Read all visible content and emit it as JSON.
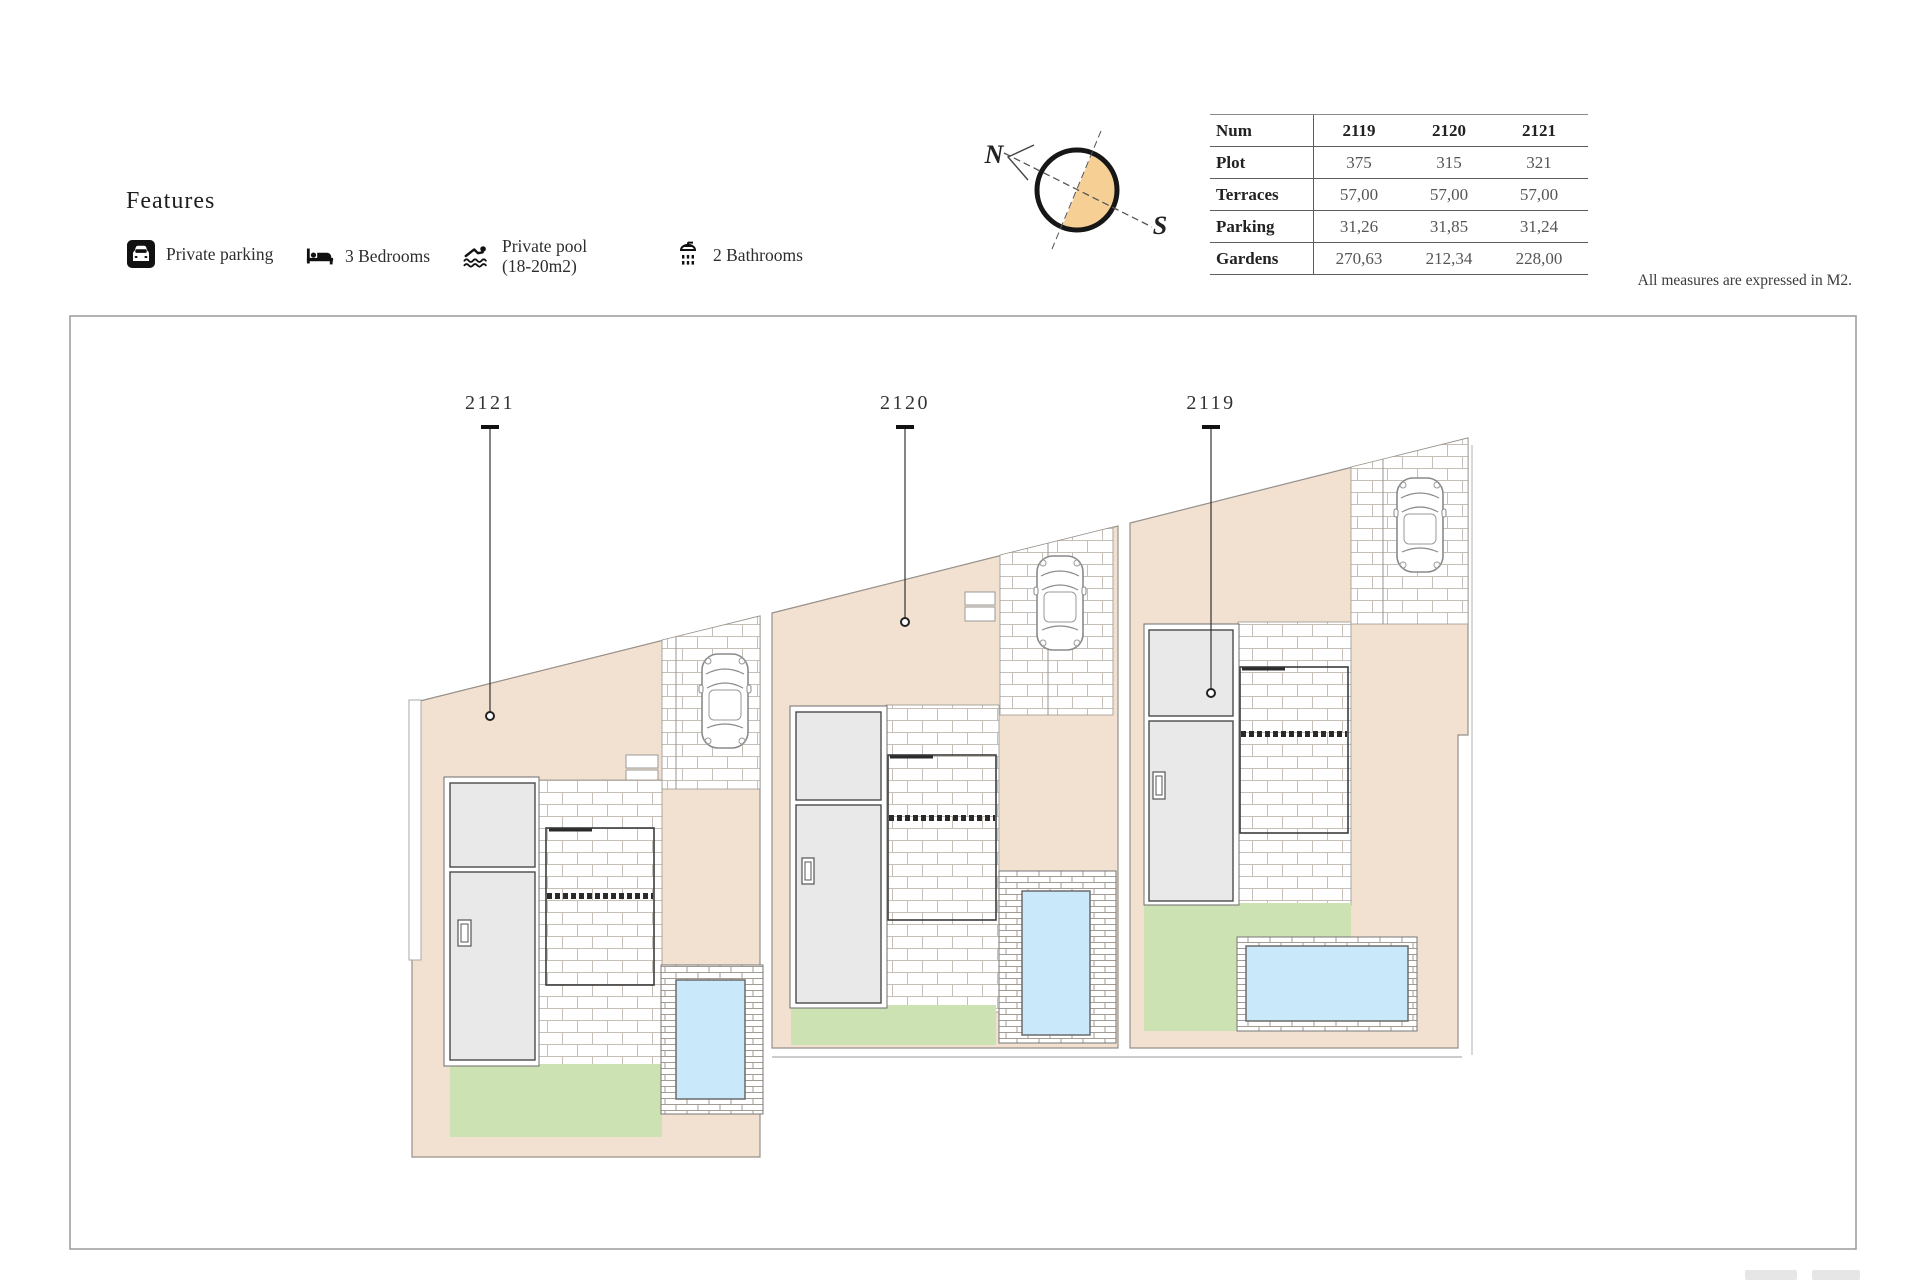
{
  "features": {
    "title": "Features",
    "items": [
      {
        "icon": "parking-icon",
        "label": "Private parking"
      },
      {
        "icon": "bed-icon",
        "label": "3 Bedrooms"
      },
      {
        "icon": "swimmer-icon",
        "label": "Private pool",
        "label2": "(18-20m2)"
      },
      {
        "icon": "shower-icon",
        "label": "2 Bathrooms"
      }
    ]
  },
  "compass": {
    "north_label": "N",
    "south_label": "S",
    "fill_color": "#f6cf95"
  },
  "table": {
    "header": {
      "label": "Num",
      "columns": [
        "2119",
        "2120",
        "2121"
      ]
    },
    "rows": [
      {
        "label": "Plot",
        "values": [
          "375",
          "315",
          "321"
        ]
      },
      {
        "label": "Terraces",
        "values": [
          "57,00",
          "57,00",
          "57,00"
        ]
      },
      {
        "label": "Parking",
        "values": [
          "31,26",
          "31,85",
          "31,24"
        ]
      },
      {
        "label": "Gardens",
        "values": [
          "270,63",
          "212,34",
          "228,00"
        ]
      }
    ]
  },
  "note": "All measures are expressed in M2.",
  "plan": {
    "plots": [
      {
        "id": "2121"
      },
      {
        "id": "2120"
      },
      {
        "id": "2119"
      }
    ],
    "colors": {
      "ground": "#f2e1d1",
      "garden": "#cde2b2",
      "pool_water": "#c9e8fa",
      "house": "#e9e9e9"
    }
  }
}
